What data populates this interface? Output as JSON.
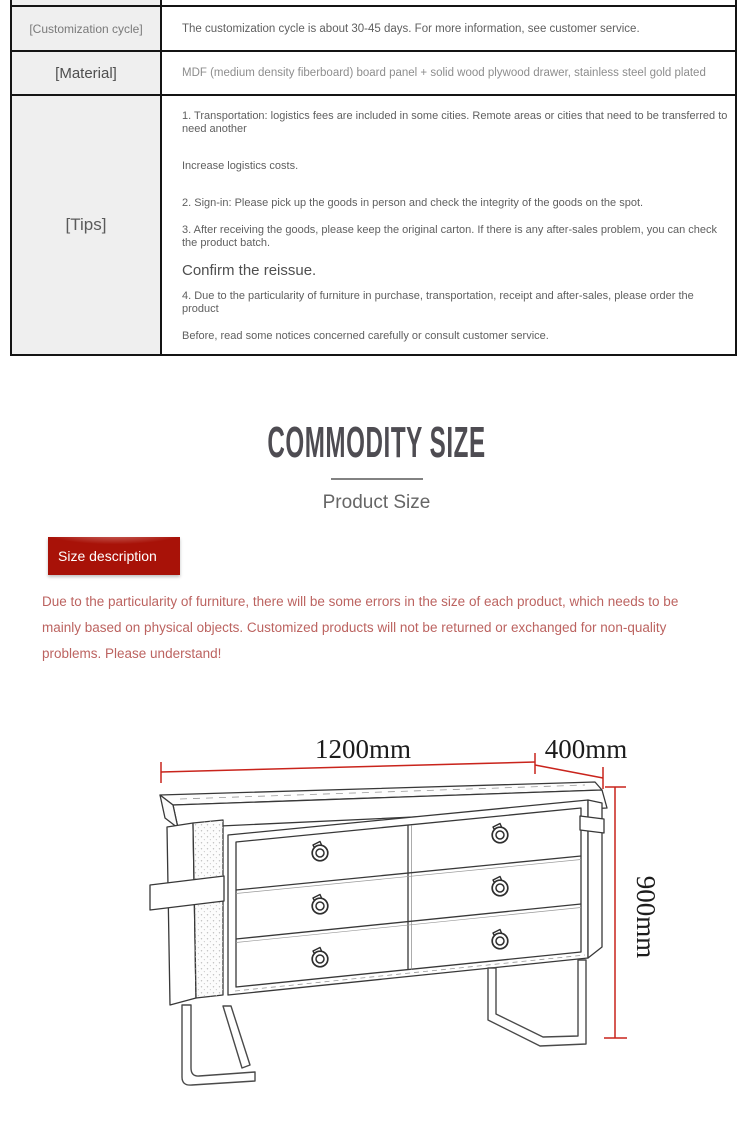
{
  "info_table": {
    "rows": [
      {
        "label": "[Customization cycle]",
        "content": "The customization cycle is about 30-45 days. For more information, see customer service."
      },
      {
        "label": "[Material]",
        "content": "MDF (medium density fiberboard) board panel + solid wood plywood drawer, stainless steel gold plated"
      },
      {
        "label": "[Tips]"
      }
    ],
    "tips_lines": [
      "1. Transportation: logistics fees are included in some cities. Remote areas or cities that need to be transferred to need another",
      "Increase logistics costs.",
      "2. Sign-in: Please pick up the goods in person and check the integrity of the goods on the spot.",
      "3. After receiving the goods, please keep the original carton. If there is any after-sales problem, you can check the product batch.",
      "Confirm the reissue.",
      "4. Due to the particularity of furniture in purchase, transportation, receipt and after-sales, please order the product",
      "Before, read some notices concerned carefully or consult customer service."
    ]
  },
  "size_section": {
    "heading": "COMMODITY SIZE",
    "subheading": "Product Size",
    "badge_label": "Size description",
    "badge_color": "#a81208",
    "note_color": "#bc6360",
    "note": "Due to the particularity of furniture, there will be some errors in the size of each product, which needs to be mainly based on physical objects. Customized products will not be returned or exchanged for non-quality problems. Please understand!"
  },
  "diagram": {
    "width_label": "1200mm",
    "depth_label": "400mm",
    "height_label": "900mm",
    "dimension_line_color": "#c9241c"
  }
}
